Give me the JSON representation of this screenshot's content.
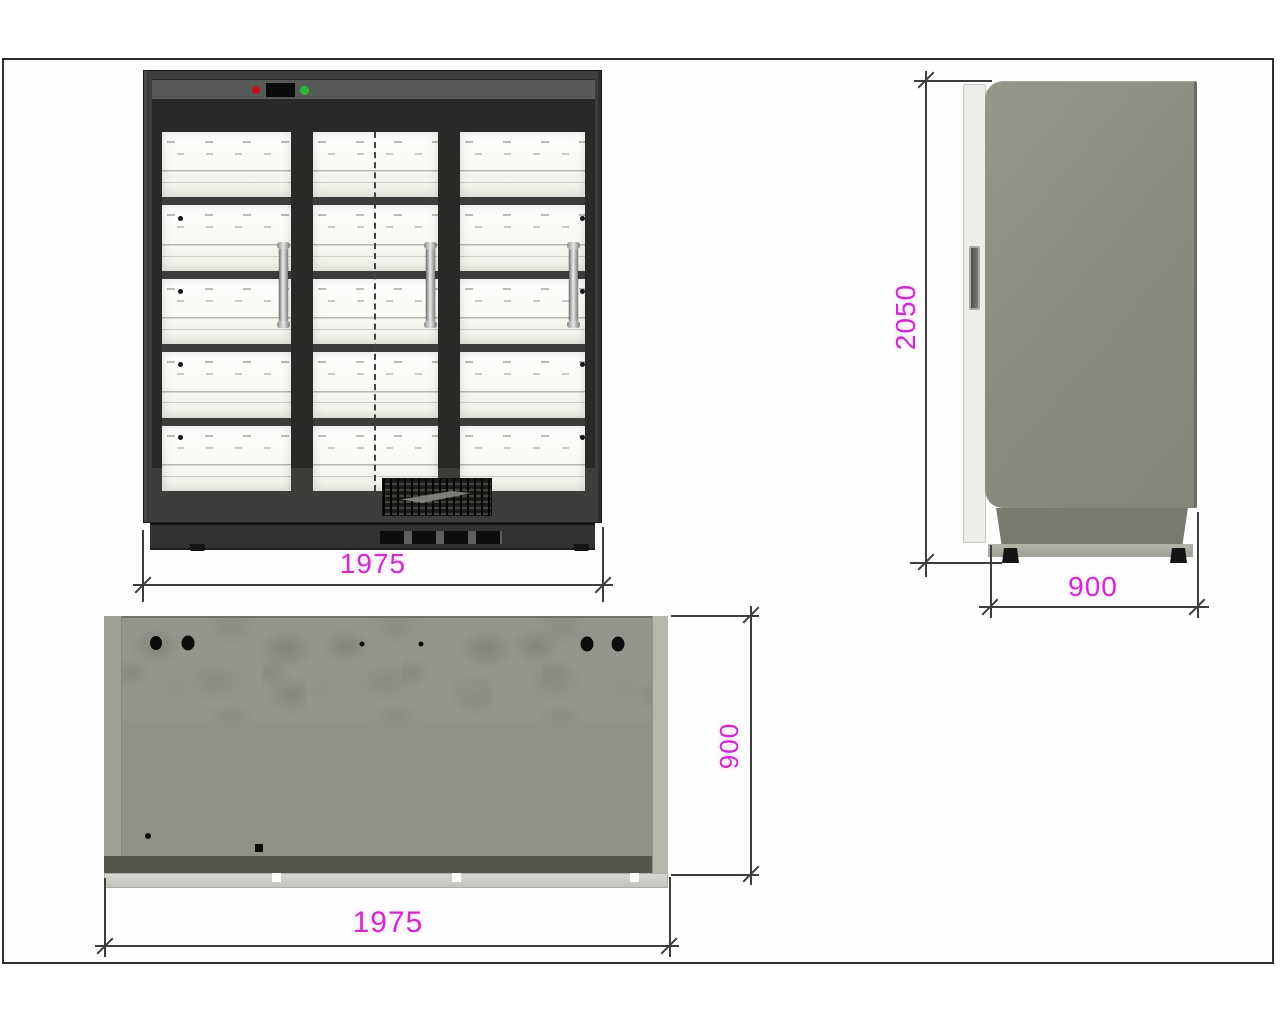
{
  "document": {
    "type": "technical-drawing",
    "subject": "refrigerated display cabinet, three views with dimensions"
  },
  "dimensions": {
    "front_width": {
      "value": "1975",
      "units_shown": false
    },
    "side_height": {
      "value": "2050",
      "units_shown": false
    },
    "side_depth": {
      "value": "900",
      "units_shown": false
    },
    "plan_depth": {
      "value": "900",
      "units_shown": false
    },
    "plan_width": {
      "value": "1975",
      "units_shown": false
    }
  },
  "front_view": {
    "doors": 3,
    "shelf_rows": 5,
    "indicators": {
      "red_light": "#c5121c",
      "display": "#0a0a0a",
      "green_light": "#2db83a"
    }
  },
  "colors": {
    "dimension_text": "#cb2dcb",
    "drawing_line": "#3d3d3d",
    "cabinet_frame": "#3b3e3b",
    "side_panel": "#8a8d80",
    "sheet_border": "#2e2e2e"
  }
}
